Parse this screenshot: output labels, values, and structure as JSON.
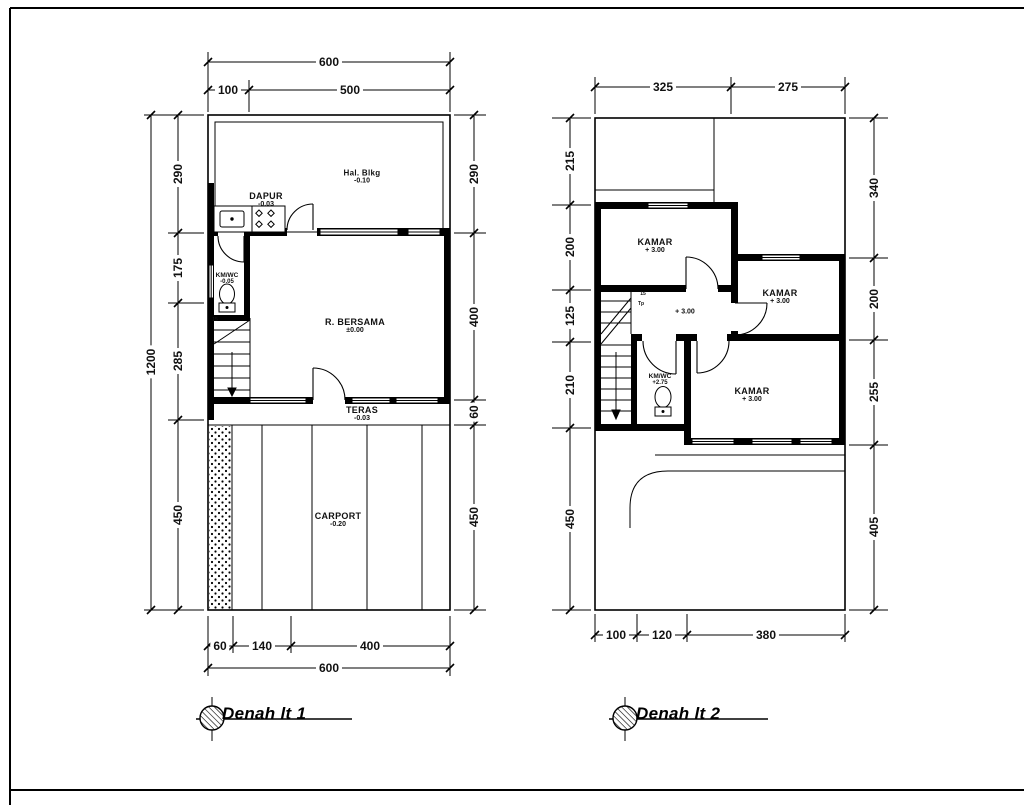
{
  "plan1": {
    "title": "Denah lt 1",
    "dims": {
      "top_overall": "600",
      "top": [
        "100",
        "500"
      ],
      "left_overall": "1200",
      "left": [
        "290",
        "175",
        "285",
        "450"
      ],
      "right": [
        "290",
        "400",
        "60",
        "450"
      ],
      "bottom": [
        "60",
        "140",
        "400"
      ],
      "bottom_overall": "600"
    },
    "rooms": {
      "hal_blkg": {
        "name": "Hal. Blkg",
        "level": "-0.10"
      },
      "dapur": {
        "name": "DAPUR",
        "level": "-0.03"
      },
      "km_wc": {
        "name": "KM/WC",
        "level": "-0.05"
      },
      "r_bersama": {
        "name": "R. BERSAMA",
        "level": "±0.00"
      },
      "teras": {
        "name": "TERAS",
        "level": "-0.03"
      },
      "carport": {
        "name": "CARPORT",
        "level": "-0.20"
      }
    },
    "stairs": {
      "label": "15"
    }
  },
  "plan2": {
    "title": "Denah lt 2",
    "dims": {
      "top": [
        "325",
        "275"
      ],
      "left": [
        "215",
        "200",
        "125",
        "210",
        "450"
      ],
      "right": [
        "340",
        "200",
        "255",
        "405"
      ],
      "bottom": [
        "100",
        "120",
        "380"
      ]
    },
    "rooms": {
      "kamar_1": {
        "name": "KAMAR",
        "level": "+ 3.00"
      },
      "kamar_2": {
        "name": "KAMAR",
        "level": "+ 3.00"
      },
      "kamar_3": {
        "name": "KAMAR",
        "level": "+ 3.00"
      },
      "hall": {
        "level": "+ 3.00"
      },
      "km_wc": {
        "name": "KM/WC",
        "level": "+2.75"
      }
    },
    "stairs": {
      "label": "15",
      "label2": "Tp"
    }
  }
}
